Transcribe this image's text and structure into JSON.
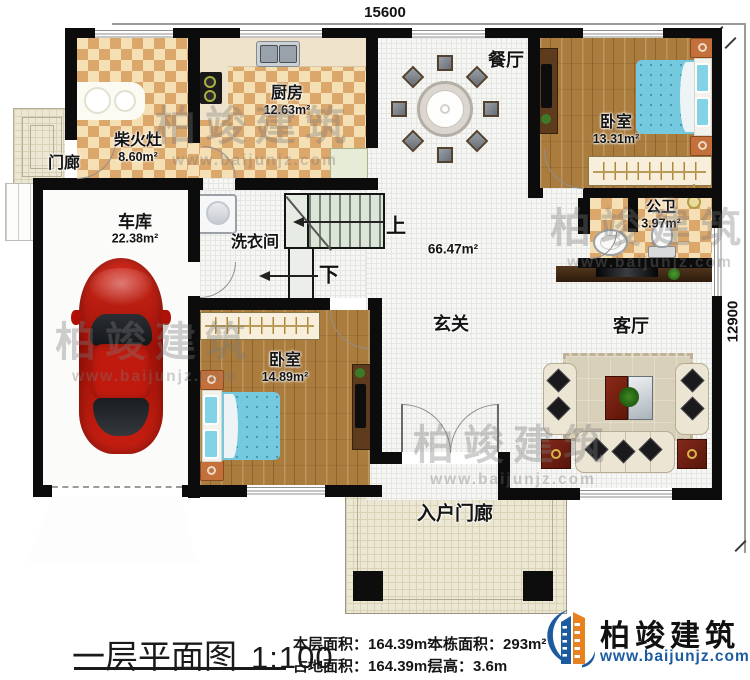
{
  "dimensions": {
    "width_top": "15600",
    "height_right": "12900"
  },
  "watermark": {
    "brand": "柏竣建筑",
    "site": "www.baijunjz.com"
  },
  "rooms": {
    "menlang": {
      "name": "门廊"
    },
    "chaihuozao": {
      "name": "柴火灶",
      "area": "8.60m²"
    },
    "chufang": {
      "name": "厨房",
      "area": "12.63m²"
    },
    "canting": {
      "name": "餐厅"
    },
    "woshi1": {
      "name": "卧室",
      "area": "13.31m²"
    },
    "cheku": {
      "name": "车库",
      "area": "22.38m²"
    },
    "xiyijian": {
      "name": "洗衣间"
    },
    "gongwei": {
      "name": "公卫",
      "area": "3.97m²"
    },
    "xuanguan": {
      "name": "玄关",
      "area": "66.47m²"
    },
    "keting": {
      "name": "客厅"
    },
    "woshi2": {
      "name": "卧室",
      "area": "14.89m²"
    },
    "ruhumenlang": {
      "name": "入户门廊"
    }
  },
  "stairs": {
    "up": "上",
    "down": "下"
  },
  "footer": {
    "title": "一层平面图",
    "scale": "1:100",
    "stats": [
      {
        "label": "本层面积：",
        "value": "164.39m²"
      },
      {
        "label": "占地面积：",
        "value": "164.39m²"
      },
      {
        "label": "本栋面积：",
        "value": "293m²"
      },
      {
        "label": "层高：",
        "value": "3.6m"
      }
    ],
    "logo": {
      "brand": "柏竣建筑",
      "site": "www.baijunjz.com"
    }
  },
  "colors": {
    "wall": "#0c0c0c",
    "brand_blue": "#1b5b9e",
    "brand_orange": "#e8821e"
  }
}
